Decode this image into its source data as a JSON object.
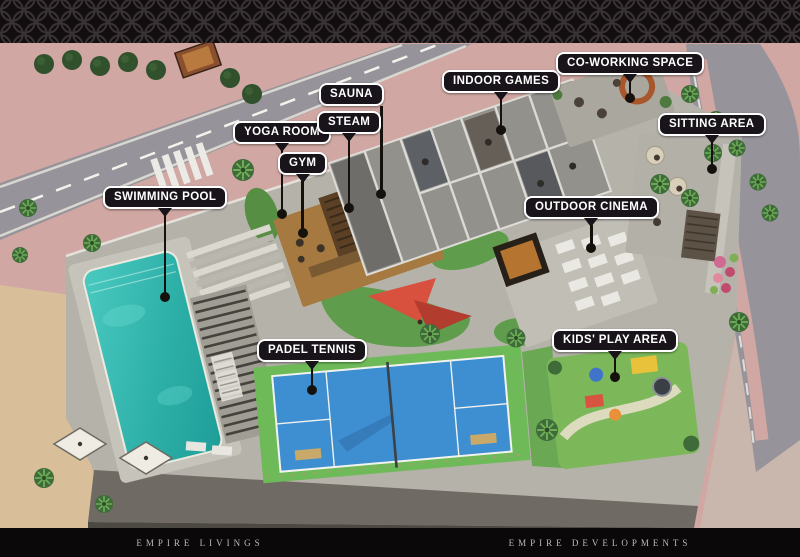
{
  "theme": {
    "header_bg": "#120d0f",
    "header_pattern": "#3a3336",
    "footer_bg": "#0b0809",
    "footer_text": "#bfb9b9",
    "label_bg": "#18141a",
    "label_border": "#ffffff",
    "label_text": "#ffffff",
    "leader": "#15110d",
    "paving": "#d0a7a2",
    "road": "#97939a",
    "sand": "#d8bf99",
    "deck": "#b5b2aa",
    "wall": "#6f6b64",
    "pool": "#2fb3ab",
    "court": "#3e8ed2",
    "court_apron": "#6eba58",
    "lawn": "#7cb85a",
    "sail": "#d8503e",
    "arch_orange": "#a8562b"
  },
  "callouts": [
    {
      "id": "swimming-pool",
      "text": "SWIMMING POOL"
    },
    {
      "id": "yoga-room",
      "text": "YOGA ROOM"
    },
    {
      "id": "gym",
      "text": "GYM"
    },
    {
      "id": "sauna",
      "text": "SAUNA"
    },
    {
      "id": "steam",
      "text": "STEAM"
    },
    {
      "id": "indoor-games",
      "text": "INDOOR GAMES"
    },
    {
      "id": "co-working-space",
      "text": "CO-WORKING SPACE"
    },
    {
      "id": "sitting-area",
      "text": "SITTING AREA"
    },
    {
      "id": "outdoor-cinema",
      "text": "OUTDOOR CINEMA"
    },
    {
      "id": "kids-play-area",
      "text": "KIDS' PLAY AREA"
    },
    {
      "id": "padel-tennis",
      "text": "PADEL TENNIS"
    }
  ],
  "footer": {
    "left_brand": "EMPIRE LIVINGS",
    "right_brand": "EMPIRE DEVELOPMENTS"
  }
}
